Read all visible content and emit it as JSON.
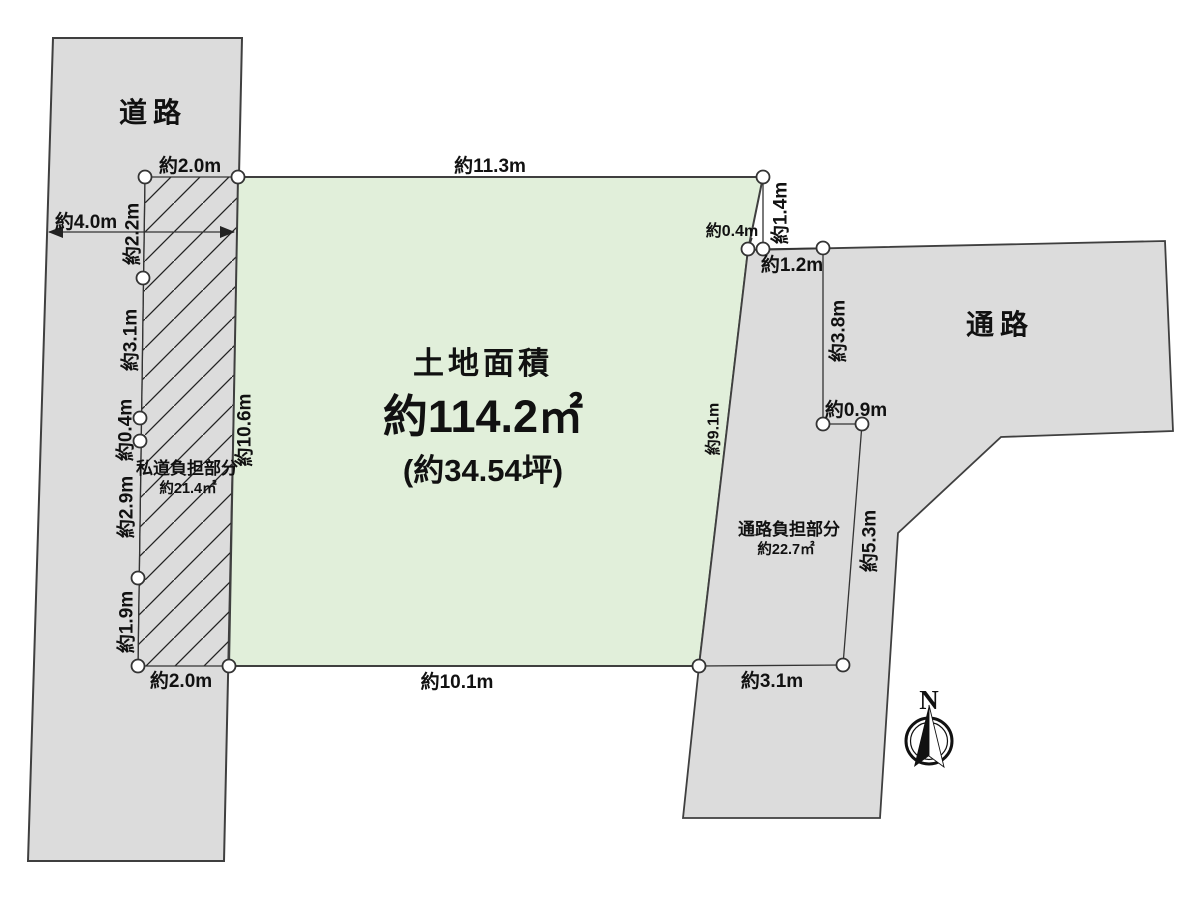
{
  "diagram": {
    "road_label": "道路",
    "passage_label": "通路",
    "plot": {
      "title": "土地面積",
      "area_sqm": "約114.2㎡",
      "area_tsubo": "(約34.54坪)"
    },
    "private_road_burden": {
      "label": "私道負担部分",
      "area": "約21.4㎡"
    },
    "passage_burden": {
      "label": "通路負担部分",
      "area": "約22.7㎡"
    },
    "compass_north": "N"
  },
  "dimensions": {
    "top_left_width": "約2.0m",
    "top_width": "約11.3m",
    "road_width": "約4.0m",
    "left_seg_1": "約2.2m",
    "left_seg_2": "約3.1m",
    "left_seg_3": "約0.4m",
    "left_seg_4": "約2.9m",
    "left_seg_5": "約1.9m",
    "hatch_right_height": "約10.6m",
    "bottom_left_width": "約2.0m",
    "bottom_width": "約10.1m",
    "right_top_height": "約1.4m",
    "right_top_offset": "約0.4m",
    "burden_top_width": "約1.2m",
    "burden_left_height": "約3.8m",
    "burden_mid_width": "約0.9m",
    "plot_right_height": "約9.1m",
    "burden_right_height": "約5.3m",
    "burden_bottom_width": "約3.1m"
  },
  "colors": {
    "road_fill": "#dcdcdc",
    "passage_fill": "#dcdcdc",
    "plot_fill": "#e1efda",
    "outline": "#3f3f3f",
    "dimension_line": "#333333",
    "text": "#111111",
    "background": "#ffffff"
  }
}
